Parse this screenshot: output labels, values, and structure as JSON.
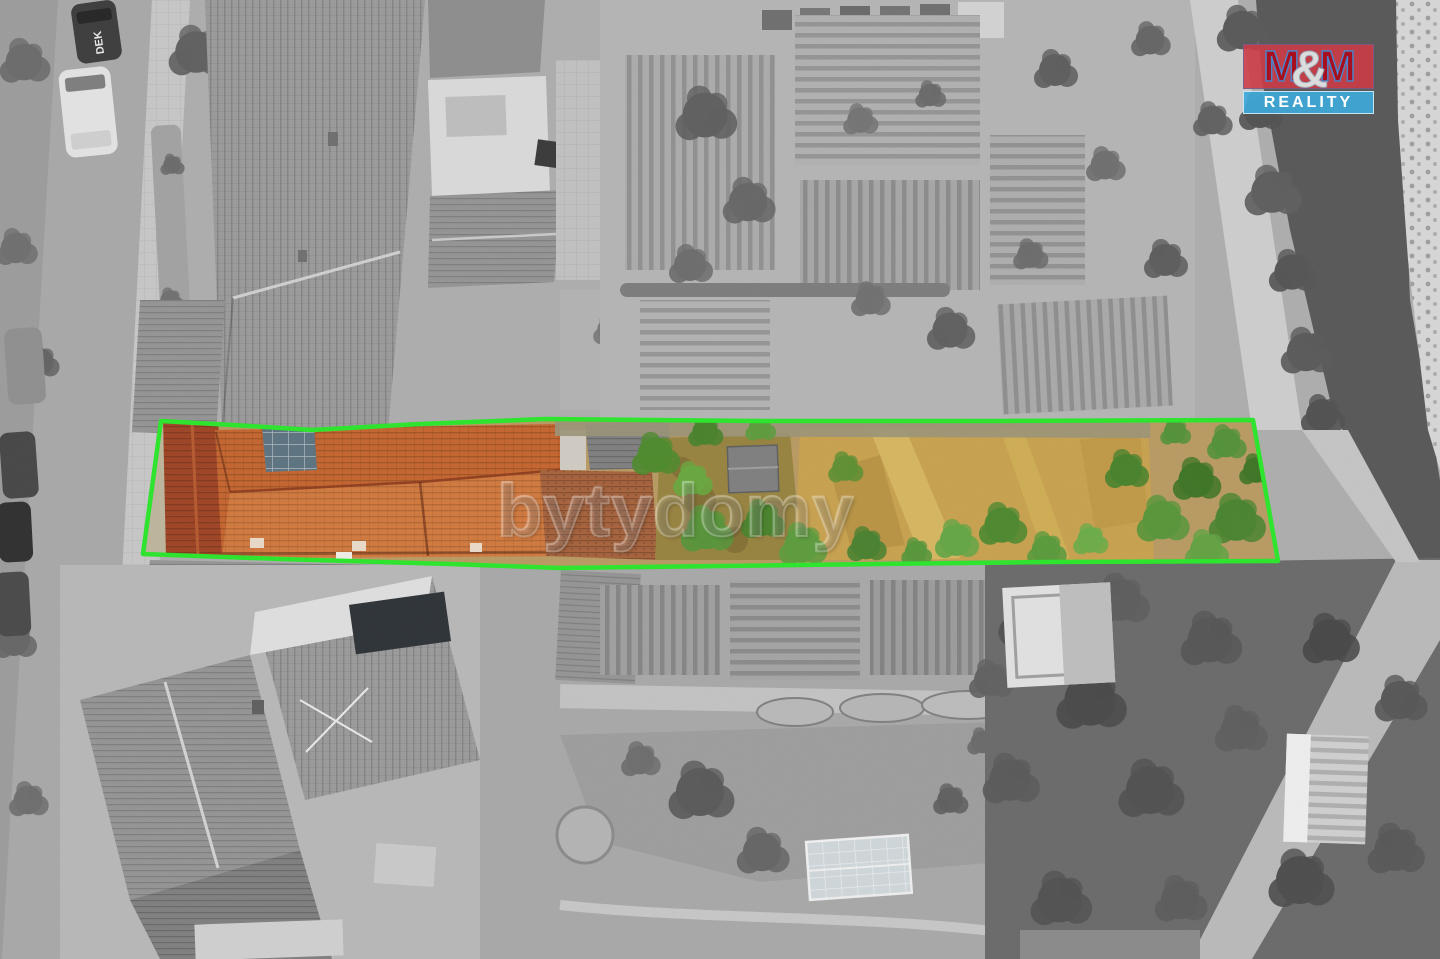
{
  "photo": {
    "type": "aerial-drone-photo",
    "description": "Top-down drone photo of a long narrow building plot; the plot (orange roofs, yard, trees, dry golden meadow) is shown in colour and circled with a green boundary line, while the surrounding street, houses, gardens and river are desaturated to grayscale.",
    "highlight_outline_color": "#2be52b"
  },
  "logo": {
    "m_left": "M",
    "ampersand": "&",
    "m_right": "M",
    "subtitle": "REALITY",
    "top_bg": "#ce3a46",
    "letter_color": "#a80f1e",
    "letter_outline": "#4d82c8",
    "amp_color": "#dcdcdc",
    "bottom_bg": "#3ea8d8",
    "subtitle_color": "#ffffff"
  },
  "watermark": {
    "text": "bytydomy"
  },
  "vehicle_label": "DEK",
  "palette": {
    "outline_green": "#2be52b",
    "roof_orange": "#c4652f",
    "roof_red": "#9e4424",
    "field_gold": "#c7a14f",
    "tree_green": "#4e8a2e",
    "water_gray": "#585858",
    "road_gray": "#a8a8a8"
  }
}
